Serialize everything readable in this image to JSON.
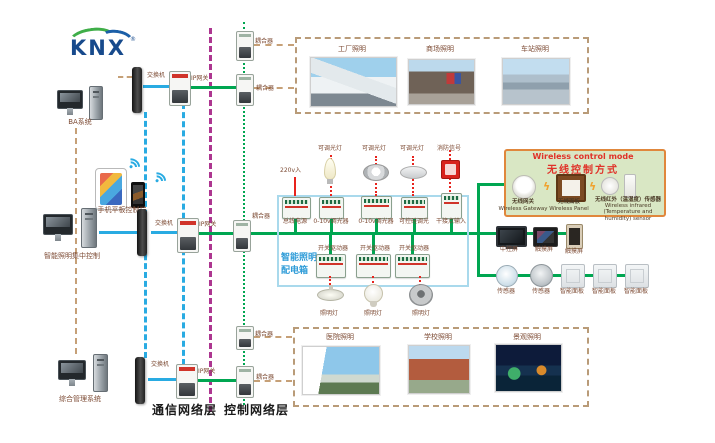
{
  "logo": {
    "text": "KNX",
    "reg": "®"
  },
  "icons": {
    "wireless_link": "ϟ"
  },
  "computers": {
    "ba": "BA系统",
    "mobile": "手机平板控制端",
    "central": "智能照明集中控制",
    "management": "综合管理系统"
  },
  "network": {
    "switch": "交换机",
    "ip_gateway": "IP网关",
    "coupler": "耦合器"
  },
  "layers": {
    "communication": "通信网络层",
    "control": "控制网络层"
  },
  "scenes": {
    "top": [
      "工厂照明",
      "商场照明",
      "车站照明"
    ],
    "bottom": [
      "医院照明",
      "学校照明",
      "景观照明"
    ]
  },
  "panel": {
    "title_line1": "智能照明",
    "title_line2": "配电箱",
    "mains": "220v入",
    "dimmable_lamp": "可调光灯",
    "fire_signal": "消防信号",
    "modules_row1": [
      "总线电源",
      "0-10v调光器",
      "0-10v调光器",
      "可控硅调光",
      "干接点输入"
    ],
    "switch_driver": "开关驱动器",
    "lamp": "照明灯"
  },
  "wireless": {
    "title_en": "Wireless control mode",
    "title_zh": "无线控制方式",
    "gateway_zh": "无线网关",
    "gateway_en": "Wireless Gateway",
    "panel_zh": "无线面板",
    "panel_en": "Wireless Panel",
    "sensor_zh": "无线红外（温湿度）传感器",
    "sensor_en": "Wireless infrared (Temperature and humidity) sensor"
  },
  "right": {
    "central_screen": "中控屏",
    "touch_screen": "触摸屏",
    "sensor": "传感器",
    "smart_panel": "智能面板"
  }
}
